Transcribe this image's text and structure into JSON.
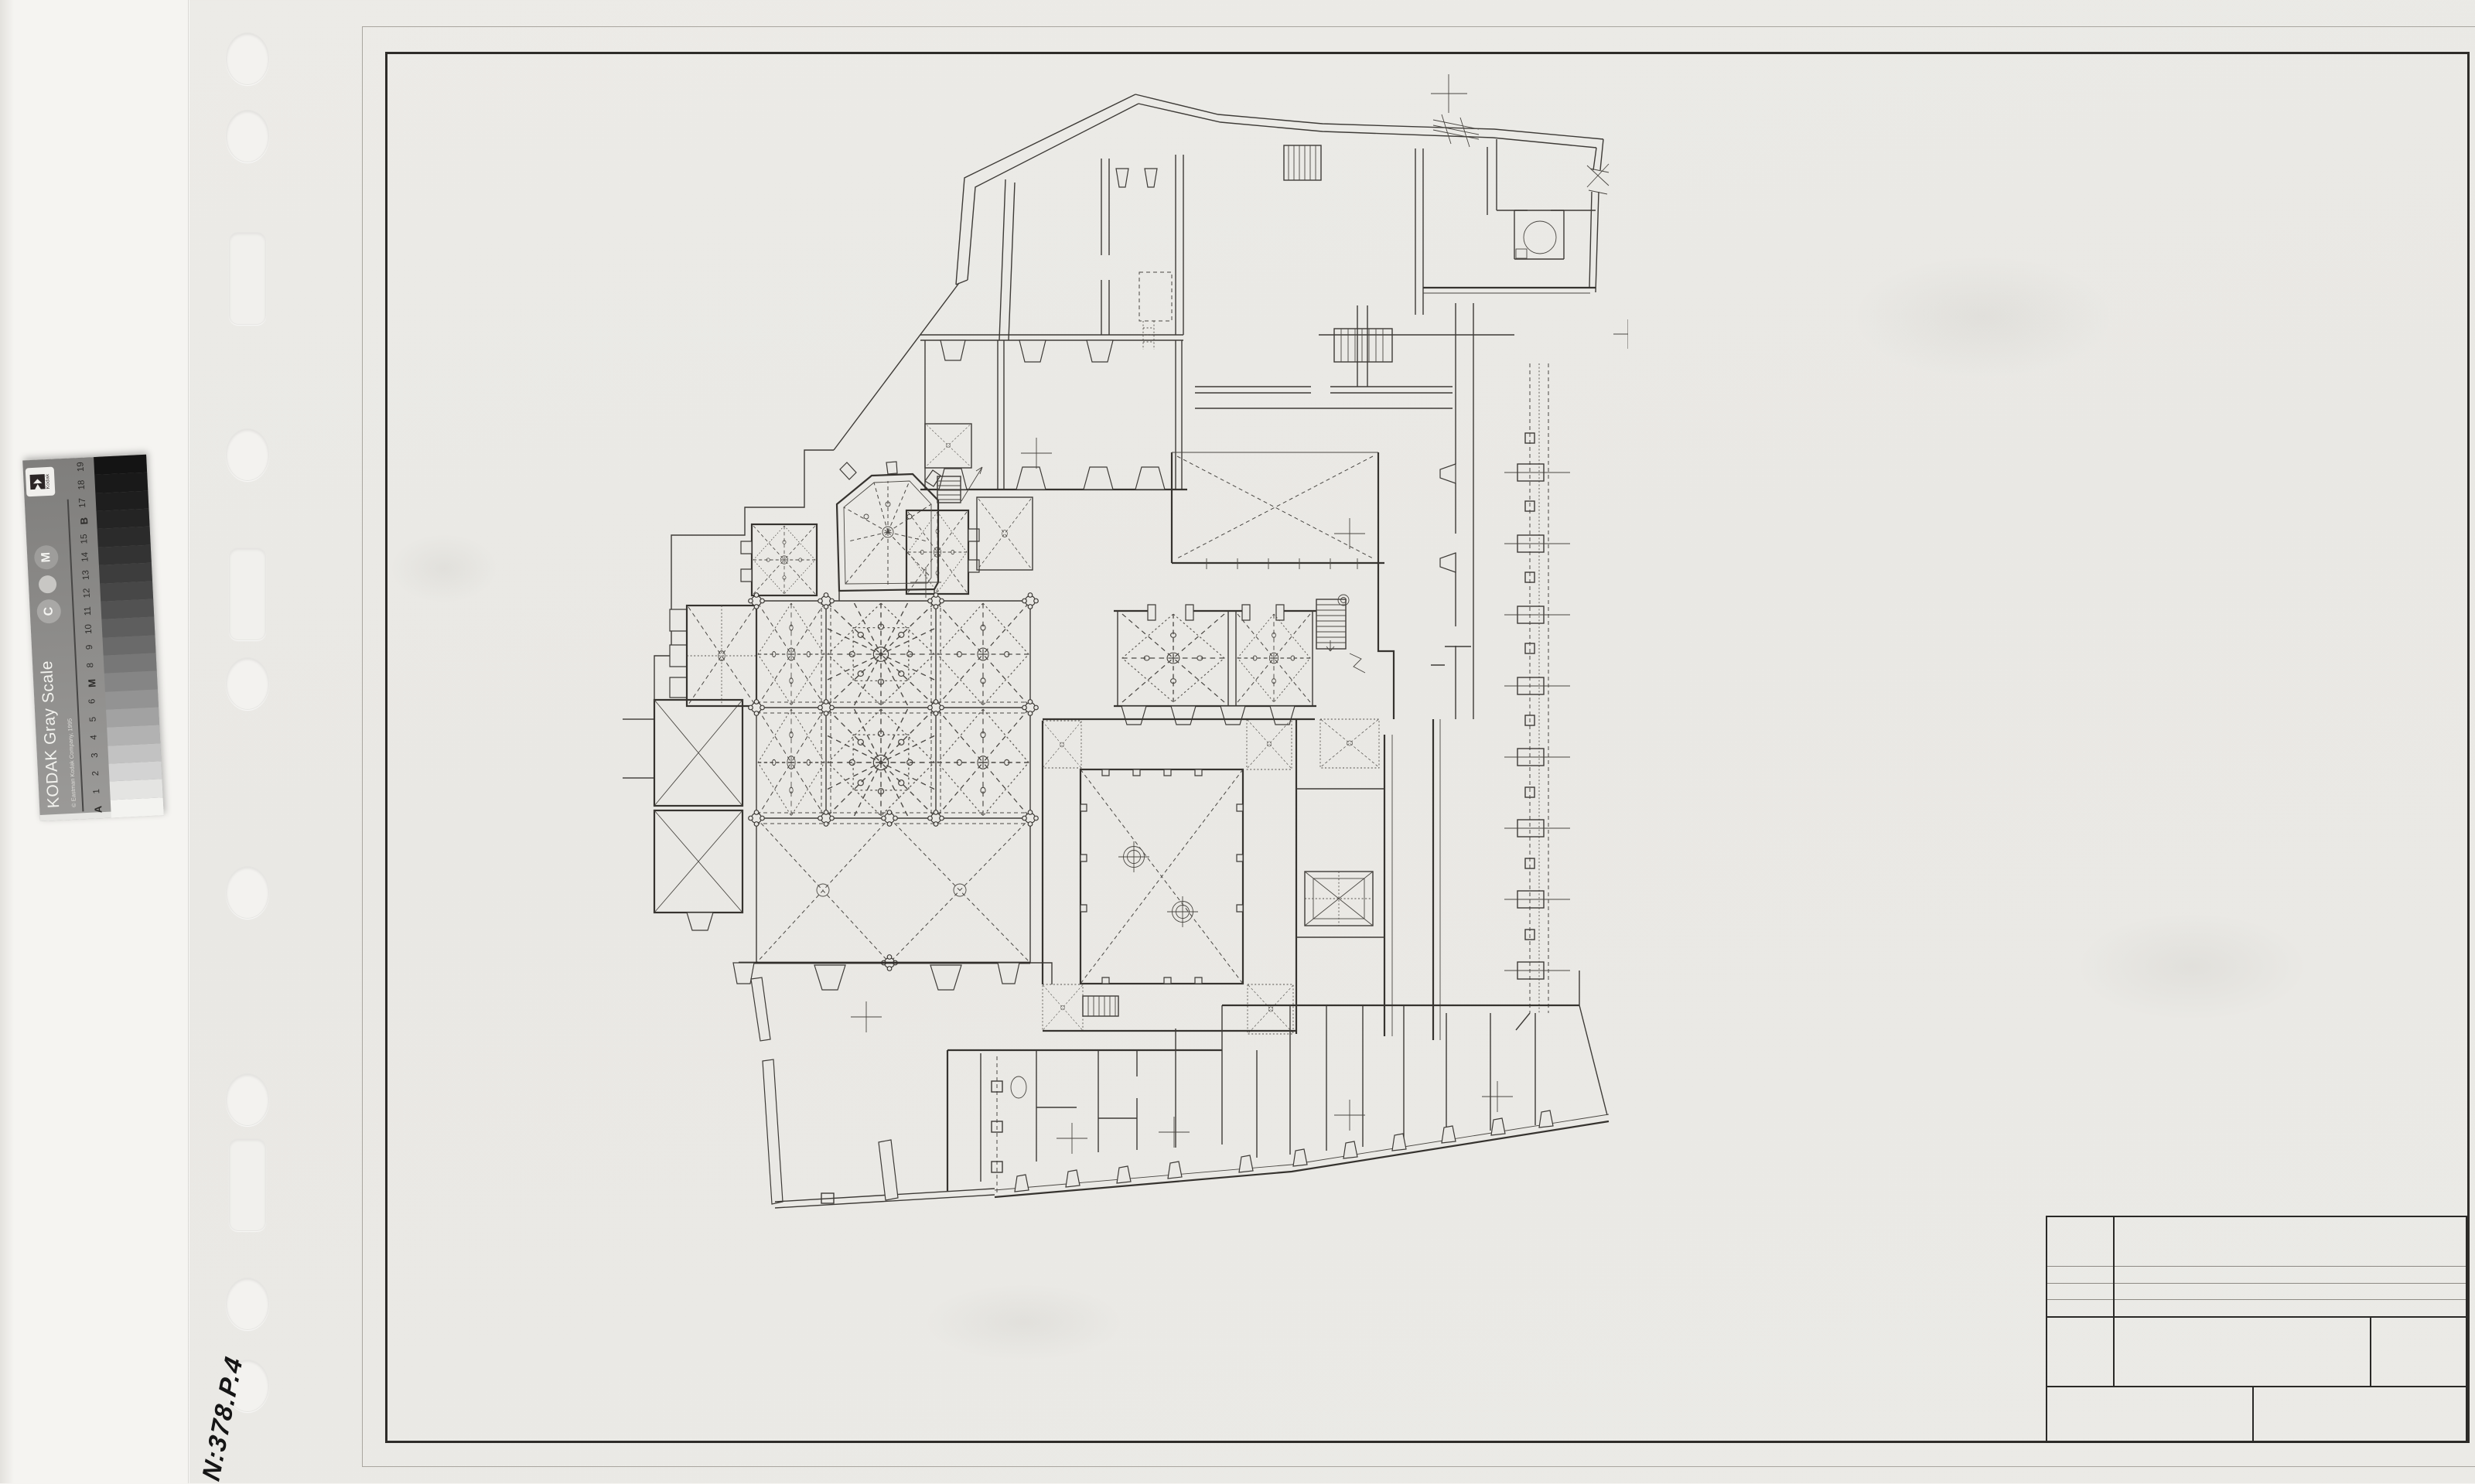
{
  "scan": {
    "colors": {
      "backing_paper": "#f5f4f1",
      "sleeve": "#ebeae6",
      "drawing_paper": "#e9e8e4",
      "frame_line": "#2e2c29",
      "plan_line": "#3e3b37",
      "strip_card": "#8d8c8a"
    }
  },
  "calibration_strip": {
    "brand": "Kodak",
    "title": "KODAK Gray Scale",
    "copyright": "© Eastman Kodak Company, 1995",
    "logo_text": "Kodak",
    "circle_labels": [
      "C",
      "M"
    ],
    "scale_labels_top_to_bottom": [
      "19",
      "18",
      "17",
      "B",
      "15",
      "14",
      "13",
      "12",
      "11",
      "10",
      "9",
      "8",
      "M",
      "6",
      "5",
      "4",
      "3",
      "2",
      "1",
      "A"
    ],
    "patch_grays_top_to_bottom": [
      "#141414",
      "#191919",
      "#1e1e1e",
      "#242424",
      "#2b2b2b",
      "#333333",
      "#3d3d3d",
      "#474747",
      "#525252",
      "#5e5e5e",
      "#6a6a6a",
      "#777777",
      "#858585",
      "#939393",
      "#a2a2a2",
      "#b2b2b2",
      "#c2c2c2",
      "#d3d3d3",
      "#e4e4e2",
      "#f3f3f0"
    ]
  },
  "handwritten_note": {
    "text": "N:378.P.4"
  },
  "title_block": {
    "visible_text": ""
  },
  "floor_plan": {
    "visible_text": ""
  }
}
